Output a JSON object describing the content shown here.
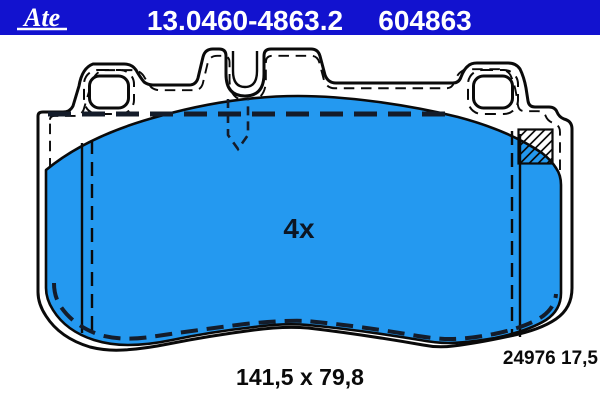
{
  "colors": {
    "header_bg": "#1212cf",
    "text_on_header": "#ffffff",
    "pad_fill": "#2499f0",
    "line": "#0a0a0a",
    "hidden_line": "#141c2a",
    "label_text": "#0a0a0a",
    "quantity_text": "#0c1624"
  },
  "header": {
    "brand": "Ate",
    "part_number": "13.0460-4863.2",
    "oe_number": "604863"
  },
  "drawing": {
    "quantity_label": "4x",
    "dimensions_label": "141,5 x 79,8",
    "reference_label": "24976 17,5"
  }
}
